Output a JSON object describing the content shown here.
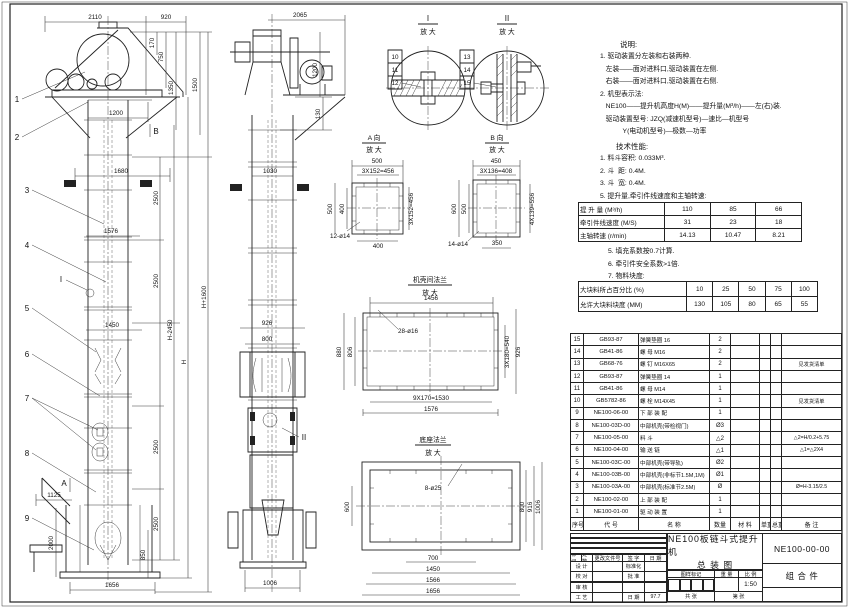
{
  "drawing": {
    "front": {
      "balloons": [
        "1",
        "2",
        "3",
        "4",
        "5",
        "6",
        "7",
        "8",
        "9"
      ],
      "d2110": "2110",
      "d920": "920",
      "d170": "170",
      "d750": "750",
      "d1350": "1350",
      "d1500": "1500",
      "d1200": "1200",
      "d1680": "1680",
      "d1576": "1576",
      "d1450": "1450",
      "d1125": "1125",
      "d2000": "2000",
      "d850": "850",
      "d1656": "1656",
      "d2500": "2500",
      "dH": "H",
      "dHm": "H-2450",
      "dHp": "H+1600",
      "mA": "A",
      "mB": "B",
      "mI": "I"
    },
    "side": {
      "d2065": "2065",
      "d1200": "1200",
      "d130": "130",
      "d1030": "1030",
      "d926": "926",
      "d800": "800",
      "d1006": "1006",
      "mII": "II"
    },
    "detail1": {
      "t": "I",
      "sub": "放 大",
      "b": [
        "10",
        "11",
        "12"
      ]
    },
    "detail2": {
      "t": "II",
      "sub": "放 大",
      "b": [
        "13",
        "14",
        "15"
      ]
    },
    "viewA": {
      "t": "A 向",
      "sub": "放 大",
      "d500t": "500",
      "dp1": "3X152=456",
      "d500l": "500",
      "d400l": "400",
      "dp2": "3X152=456",
      "holes": "12-ø14",
      "d400b": "400"
    },
    "viewB": {
      "t": "B 向",
      "sub": "放 大",
      "d450": "450",
      "dp1": "3X136=408",
      "d600": "600",
      "d500": "500",
      "dp2": "4X139=556",
      "holes": "14-ø14",
      "d350": "350"
    },
    "flange": {
      "t": "机壳间法兰",
      "sub": "放 大",
      "d1456": "1456",
      "holes": "28-ø16",
      "d880": "880",
      "d806": "806",
      "dp": "3X180=540",
      "d926": "926",
      "dpb": "9X170=1530",
      "d1576": "1576"
    },
    "base": {
      "t": "底座法兰",
      "sub": "放 大",
      "holes": "8-ø25",
      "d600": "600",
      "d800": "800",
      "d916": "916",
      "d1006": "1006",
      "d700": "700",
      "d1450": "1450",
      "d1566": "1566",
      "d1656": "1656"
    }
  },
  "notes": {
    "heading": "说明:",
    "lines": [
      "1. 驱动装置分左装和右装两种.",
      "   左装——面对进料口,驱动装置在左侧.",
      "   右装——面对进料口,驱动装置在右侧.",
      "2. 机型表示法:",
      "   NE100——提升机高度H(M)——提升量(M³/h)——左(右)装.",
      "   驱动装置型号: JZQ(减速机型号)—速比—机型号",
      "            Y(电动机型号)—极数—功率"
    ]
  },
  "tech": {
    "heading": "技术性能:",
    "lines": [
      "1. 料斗容积: 0.033M³.",
      "2. 斗  距: 0.4M.",
      "3. 斗  宽: 0.4M.",
      "5. 提升量,牵引件线速度和主轴转速:"
    ]
  },
  "perf_table": {
    "rows": [
      {
        "label": "提 升 量 (M³/h)",
        "v": [
          "110",
          "85",
          "66"
        ]
      },
      {
        "label": "牵引件线速度 (M/S)",
        "v": [
          "31",
          "23",
          "18"
        ]
      },
      {
        "label": "主轴转速 (r/min)",
        "v": [
          "14.13",
          "10.47",
          "8.21"
        ]
      }
    ]
  },
  "notes2": [
    "5. 填充系数按0.7计算.",
    "6. 牵引件安全系数>1倍.",
    "7. 物料块度:"
  ],
  "size_table": {
    "rows": [
      {
        "label": "大块料所占百分比 (%)",
        "v": [
          "10",
          "25",
          "50",
          "75",
          "100"
        ]
      },
      {
        "label": "允许大块料块度 (MM)",
        "v": [
          "130",
          "105",
          "80",
          "65",
          "55"
        ]
      }
    ]
  },
  "bom": {
    "headers": [
      "序号",
      "代  号",
      "名  称",
      "数量",
      "材  料",
      "单重",
      "总重",
      "备  注"
    ],
    "rows": [
      {
        "no": "15",
        "code": "GB93-87",
        "name": "弹簧垫圈 16",
        "qty": "2",
        "remark": ""
      },
      {
        "no": "14",
        "code": "GB41-86",
        "name": "螺 母 M16",
        "qty": "2",
        "remark": ""
      },
      {
        "no": "13",
        "code": "GB68-76",
        "name": "螺 钉 M16X65",
        "qty": "2",
        "remark": "见发货清单"
      },
      {
        "no": "12",
        "code": "GB93-87",
        "name": "弹簧垫圈 14",
        "qty": "1",
        "remark": ""
      },
      {
        "no": "11",
        "code": "GB41-86",
        "name": "螺 母 M14",
        "qty": "1",
        "remark": ""
      },
      {
        "no": "10",
        "code": "GB5782-86",
        "name": "螺 栓 M14X45",
        "qty": "1",
        "remark": "见发货清单"
      },
      {
        "no": "9",
        "code": "NE100-06-00",
        "name": "下 部 装 配",
        "qty": "1",
        "remark": ""
      },
      {
        "no": "8",
        "code": "NE100-03D-00",
        "name": "中部机壳(带检视门)",
        "qty": "Ø3",
        "remark": ""
      },
      {
        "no": "7",
        "code": "NE100-05-00",
        "name": "料 斗",
        "qty": "△2",
        "remark": "△2=H/0.2+5.75"
      },
      {
        "no": "6",
        "code": "NE100-04-00",
        "name": "输 送 链",
        "qty": "△1",
        "remark": "△1=△2X4"
      },
      {
        "no": "5",
        "code": "NE100-03C-00",
        "name": "中部机壳(带导轨)",
        "qty": "Ø2",
        "remark": ""
      },
      {
        "no": "4",
        "code": "NE100-03B-00",
        "name": "中部机壳(非标节1.5M,1M)",
        "qty": "Ø1",
        "remark": ""
      },
      {
        "no": "3",
        "code": "NE100-03A-00",
        "name": "中部机壳(标准节2.5M)",
        "qty": "Ø",
        "remark": "Ø=H-3.15/2.5"
      },
      {
        "no": "2",
        "code": "NE100-02-00",
        "name": "上 部 装 配",
        "qty": "1",
        "remark": ""
      },
      {
        "no": "1",
        "code": "NE100-01-00",
        "name": "驱 动 装 置",
        "qty": "1",
        "remark": ""
      }
    ]
  },
  "title_block": {
    "rev_cols": [
      "标记",
      "处数",
      "更改文件号",
      "签 字",
      "日 期"
    ],
    "sig_rows": [
      {
        "a": "设 计",
        "b": "标准化",
        "c": ""
      },
      {
        "a": "校 对",
        "b": "批 准",
        "c": ""
      },
      {
        "a": "审 核",
        "b": "",
        "c": ""
      },
      {
        "a": "工 艺",
        "b": "日 期",
        "c": "97.7"
      }
    ],
    "stamp_cols": [
      "图样标记",
      "重 量",
      "比 例"
    ],
    "scale": "1:50",
    "sheet_info_a": "共  张",
    "sheet_info_b": "第  张",
    "title_line1": "NE100板链斗式提升机",
    "title_line2": "总  装  图",
    "drawing_no": "NE100-00-00",
    "part_type": "组 合 件"
  }
}
